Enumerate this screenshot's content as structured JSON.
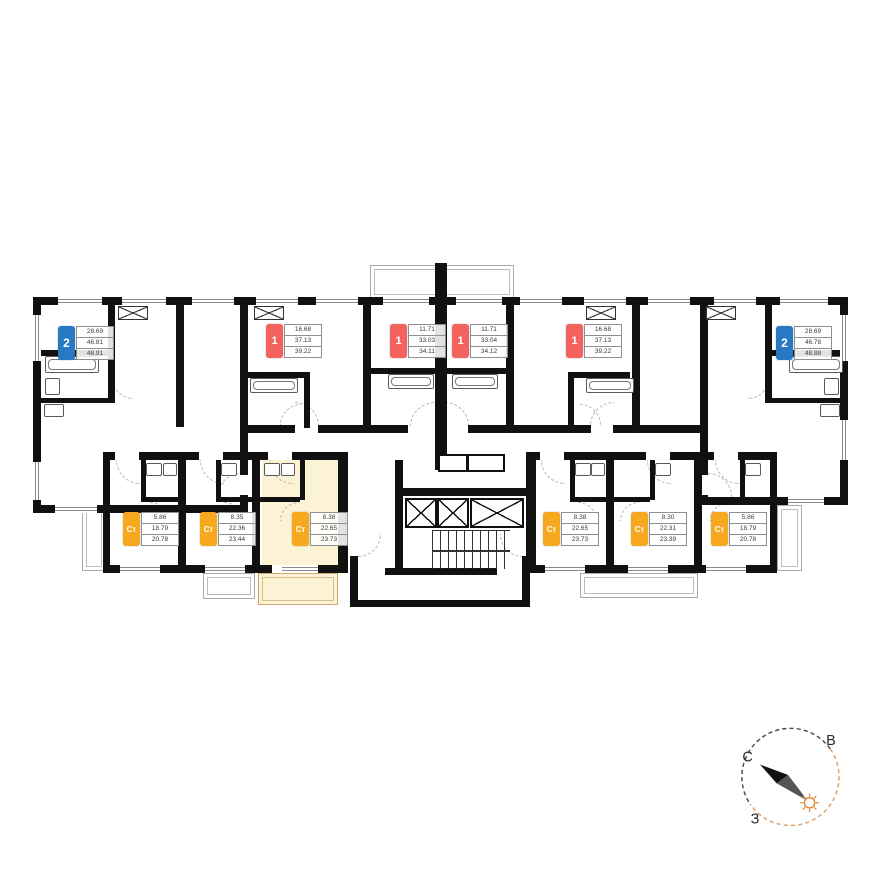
{
  "colors": {
    "badge_blue": "#2779c4",
    "badge_red": "#f4625e",
    "badge_yellow": "#f6a81f",
    "highlight_fill": "#fcf3d5",
    "highlight_border": "#c9a96e",
    "wall": "#111111"
  },
  "units": [
    {
      "id": "2k-left",
      "type": "2",
      "color": "blue",
      "v": [
        "28.69",
        "46.81",
        "48.91"
      ]
    },
    {
      "id": "1k-left",
      "type": "1",
      "color": "red",
      "v": [
        "16.68",
        "37.13",
        "39.22"
      ]
    },
    {
      "id": "1k-mid-left",
      "type": "1",
      "color": "red",
      "v": [
        "11.71",
        "33.03",
        "34.11"
      ]
    },
    {
      "id": "1k-mid-right",
      "type": "1",
      "color": "red",
      "v": [
        "11.71",
        "33.04",
        "34.12"
      ]
    },
    {
      "id": "1k-right",
      "type": "1",
      "color": "red",
      "v": [
        "16.68",
        "37.13",
        "39.22"
      ]
    },
    {
      "id": "2k-right",
      "type": "2",
      "color": "blue",
      "v": [
        "28.69",
        "46.78",
        "48.88"
      ]
    },
    {
      "id": "st-1",
      "type": "Ст",
      "color": "yellow",
      "v": [
        "5.86",
        "18.79",
        "20.78"
      ]
    },
    {
      "id": "st-2",
      "type": "Ст",
      "color": "yellow",
      "v": [
        "8.35",
        "22.36",
        "23.44"
      ]
    },
    {
      "id": "st-3-selected",
      "type": "Ст",
      "color": "yellow",
      "v": [
        "8.38",
        "22.65",
        "23.73"
      ],
      "highlighted": true
    },
    {
      "id": "st-4",
      "type": "Ст",
      "color": "yellow",
      "v": [
        "8.38",
        "22.65",
        "23.73"
      ]
    },
    {
      "id": "st-5",
      "type": "Ст",
      "color": "yellow",
      "v": [
        "8.30",
        "22.31",
        "23.39"
      ]
    },
    {
      "id": "st-6",
      "type": "Ст",
      "color": "yellow",
      "v": [
        "5.86",
        "18.79",
        "20.78"
      ]
    }
  ],
  "compass": {
    "north": "С",
    "east": "В",
    "west": "З"
  }
}
